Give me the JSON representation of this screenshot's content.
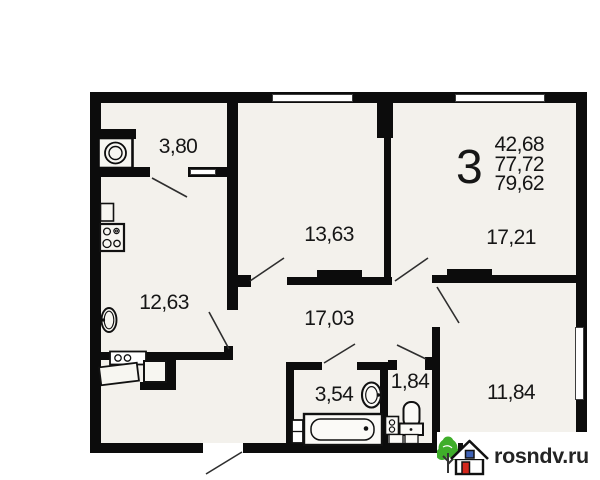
{
  "apartment_summary": {
    "rooms_count": "3",
    "values": [
      "42,68",
      "77,72",
      "79,62"
    ]
  },
  "room_areas": {
    "storage": "3,80",
    "living_room": "13,63",
    "bedroom_top_right": "17,21",
    "kitchen": "12,63",
    "hallway": "17,03",
    "bathroom": "3,54",
    "wc": "1,84",
    "bedroom_bottom_right": "11,84"
  },
  "logo": {
    "text": "rosndv.ru"
  },
  "colors": {
    "wall": "#0c0c0c",
    "floor": "#f3f1ec",
    "logo_green": "#3fae2a",
    "logo_red": "#d3271c",
    "logo_blue": "#3f62b5"
  }
}
